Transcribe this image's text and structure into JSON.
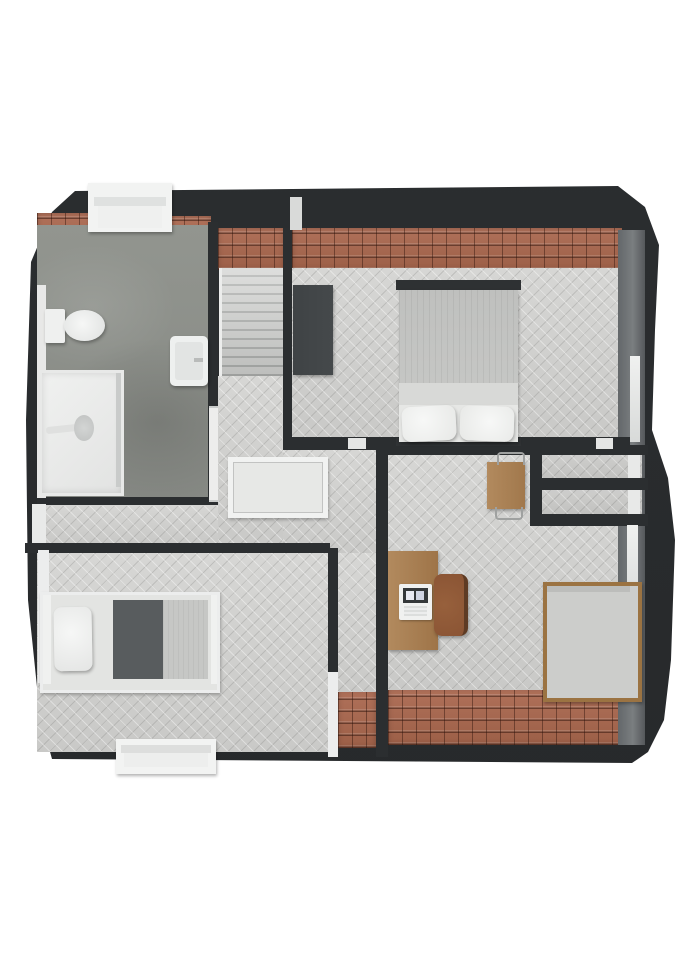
{
  "meta": {
    "title": "3D floor plan render — attic storey (top-down view)",
    "render_style": "photoreal top-down dollhouse"
  },
  "palette": {
    "page": "#ffffff",
    "wall": "#2b2e30",
    "wallLight": "#7a7e80",
    "roof": "#9c5f47",
    "roofLine": "#5f3424",
    "wood": "#d6d6d4",
    "woodLine": "#bfbfbd",
    "concrete": "#868984",
    "fixture": "#f2f3f2",
    "fixtureShade": "#d9dbda",
    "timber": "#b28a5e",
    "timberDark": "#8a5434",
    "fabricDark": "#585c5e",
    "fabricLight": "#c9cac8",
    "wardrobe": "#45494b"
  },
  "rooms": [
    {
      "id": "bathroom",
      "name": "Bathroom",
      "floor": "concrete"
    },
    {
      "id": "staircase",
      "name": "Staircase",
      "floor": "stair treads"
    },
    {
      "id": "bedroom-main",
      "name": "Bedroom with double bed",
      "floor": "herringbone wood"
    },
    {
      "id": "hallway",
      "name": "Landing / hallway with stair void",
      "floor": "herringbone wood"
    },
    {
      "id": "bedroom-single",
      "name": "Bedroom with single bed",
      "floor": "herringbone wood"
    },
    {
      "id": "study-bedroom",
      "name": "Study / bedroom with desk",
      "floor": "herringbone wood"
    },
    {
      "id": "storage",
      "name": "Built-in eaves storage compartments",
      "floor": "grey"
    }
  ],
  "furniture": [
    {
      "id": "toilet",
      "name": "Toilet"
    },
    {
      "id": "washbasin",
      "name": "Washbasin"
    },
    {
      "id": "shower",
      "name": "Walk-in shower"
    },
    {
      "id": "stair-railing",
      "name": "Stair-void railing"
    },
    {
      "id": "wardrobe",
      "name": "Dark wardrobe"
    },
    {
      "id": "double-bed",
      "name": "Double bed with two pillows"
    },
    {
      "id": "single-bed-left",
      "name": "Single bed, white frame, dark blanket"
    },
    {
      "id": "desk",
      "name": "Wooden desk"
    },
    {
      "id": "laptop",
      "name": "Laptop on desk"
    },
    {
      "id": "desk-chair",
      "name": "Desk chair"
    },
    {
      "id": "side-table",
      "name": "Small wooden table with wire chairs"
    },
    {
      "id": "single-bed-right",
      "name": "Single bed, wooden frame"
    },
    {
      "id": "storage-shelves",
      "name": "Storage shelf compartments"
    }
  ],
  "openings": [
    {
      "id": "dormer-top",
      "name": "Dormer window, top wall (bathroom)"
    },
    {
      "id": "bathroom-door",
      "name": "Bathroom door (white)"
    },
    {
      "id": "window-hall-left",
      "name": "Window, left wall at hallway"
    },
    {
      "id": "window-bed-left",
      "name": "Window, left wall at single bedroom"
    },
    {
      "id": "dormer-bottom",
      "name": "Dormer window, bottom wall (single bedroom)"
    },
    {
      "id": "window-right-bedroom",
      "name": "Window, right wall (double bedroom)"
    },
    {
      "id": "window-right-study",
      "name": "Window, right wall (study)"
    },
    {
      "id": "threshold-bedroom-door",
      "name": "Door threshold, double bedroom"
    },
    {
      "id": "threshold-closet-door",
      "name": "Door threshold near storage"
    },
    {
      "id": "white-divider",
      "name": "White wall divider strip (corridor end)"
    }
  ]
}
